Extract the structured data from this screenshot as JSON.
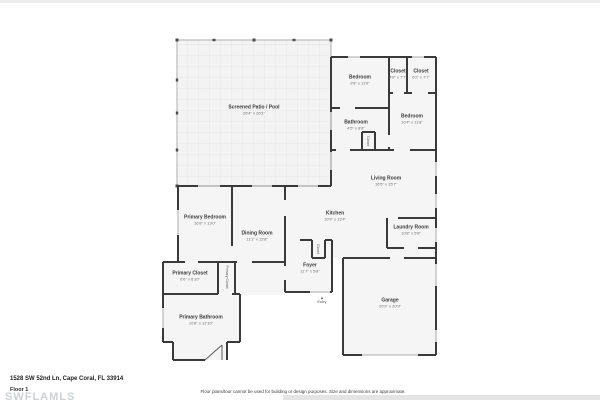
{
  "plan": {
    "colors": {
      "wall": "#3a3a3a",
      "screen_wall": "#c6c6c6",
      "room_fill": "#f5f5f5",
      "patio_fill": "#f3f3f3",
      "patio_grid": "#e7e7e7",
      "thin_line": "#ababab"
    },
    "rooms": [
      {
        "id": "screened-patio-pool",
        "name": "Screened Patio / Pool",
        "dims": "26'4\" x 26'1\""
      },
      {
        "id": "bedroom-top",
        "name": "Bedroom",
        "dims": "9'8\" x 11'6\""
      },
      {
        "id": "closet-top-left",
        "name": "Closet",
        "dims": "4'8\" x 7'7\""
      },
      {
        "id": "closet-top-right",
        "name": "Closet",
        "dims": "6'2\" x 7'7\""
      },
      {
        "id": "bathroom",
        "name": "Bathroom",
        "dims": "4'5\" x 8'8\""
      },
      {
        "id": "bedroom-right",
        "name": "Bedroom",
        "dims": "10'4\" x 11'8\""
      },
      {
        "id": "living-room",
        "name": "Living Room",
        "dims": "16'5\" x 15'7\""
      },
      {
        "id": "kitchen",
        "name": "Kitchen",
        "dims": "10'9\" x 13'4\""
      },
      {
        "id": "laundry-room",
        "name": "Laundry Room",
        "dims": "10'8\" x 5'8\""
      },
      {
        "id": "primary-bedroom",
        "name": "Primary Bedroom",
        "dims": "16'8\" x 13'0\""
      },
      {
        "id": "dining-room",
        "name": "Dining Room",
        "dims": "11'1\" x 12'8\""
      },
      {
        "id": "foyer",
        "name": "Foyer",
        "dims": "11'7\" x 5'8\""
      },
      {
        "id": "primary-closet",
        "name": "Primary Closet",
        "dims": "6'6\" x 6'10\""
      },
      {
        "id": "primary-closet-2",
        "name": "Primary Closet",
        "dims": "4'7\" x 11'5\""
      },
      {
        "id": "primary-bathroom",
        "name": "Primary Bathroom",
        "dims": "10'8\" x 12'10\""
      },
      {
        "id": "garage",
        "name": "Garage",
        "dims": "20'9\" x 20'9\""
      },
      {
        "id": "closet-foyer",
        "name": "Closet",
        "dims": ""
      },
      {
        "id": "closet-bathroom",
        "name": "Closet",
        "dims": ""
      }
    ],
    "entry_label": "Entry",
    "entry_icon": "▲"
  },
  "footer": {
    "address": "1528 SW 52nd Ln, Cape Coral, FL 33914",
    "floor_label": "Floor 1",
    "watermark": "SWFLAMLS",
    "disclaimer": "Floor plans/tour cannot be used for building or design purposes. Size and dimensions are approximate."
  }
}
